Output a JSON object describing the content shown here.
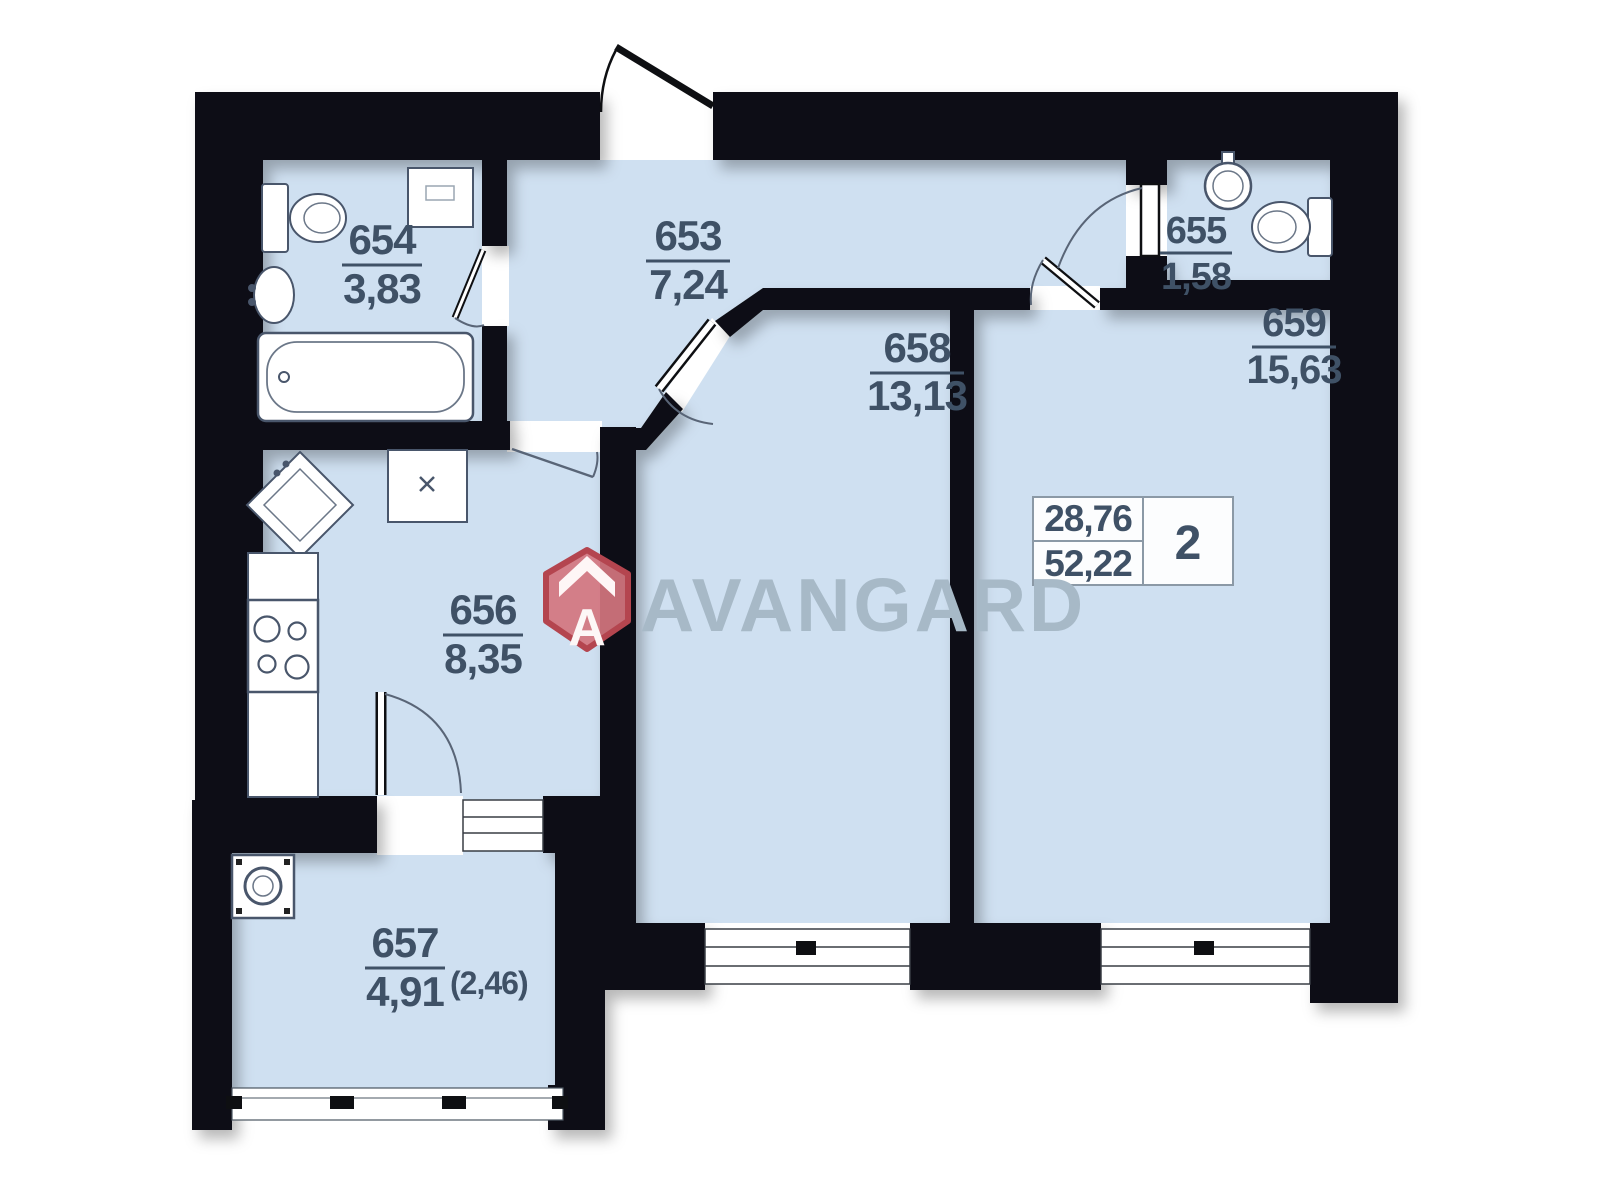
{
  "plan": {
    "type": "apartment-floor-plan",
    "rooms": {
      "r653": {
        "number": "653",
        "area": "7,24"
      },
      "r654": {
        "number": "654",
        "area": "3,83"
      },
      "r655": {
        "number": "655",
        "area": "1,58"
      },
      "r656": {
        "number": "656",
        "area": "8,35"
      },
      "r657": {
        "number": "657",
        "area": "4,91",
        "area_secondary": "(2,46)"
      },
      "r658": {
        "number": "658",
        "area": "13,13"
      },
      "r659": {
        "number": "659",
        "area": "15,63"
      }
    },
    "info_box": {
      "upper_value": "28,76",
      "lower_value": "52,22",
      "rooms_count": "2"
    },
    "logo": {
      "text": "AVANGARD",
      "icon_letter": "A"
    },
    "colors": {
      "floor_fill": "#cfe0f1",
      "wall": "#0e0f12",
      "label_text": "#3f5166",
      "logo_text": "#a7b9c7",
      "logo_icon_fill": "#d4757f",
      "logo_icon_stroke": "#b4454f"
    }
  }
}
